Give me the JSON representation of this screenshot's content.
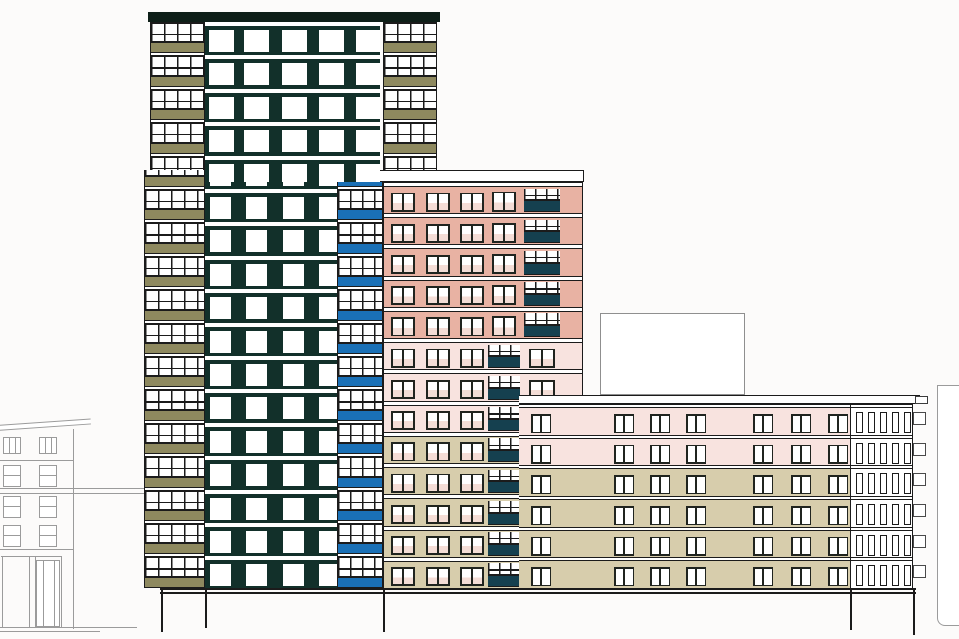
{
  "scene": {
    "width": 959,
    "height": 639,
    "background": "#fcfbfa"
  },
  "colors": {
    "line": "#1b1b1b",
    "frame": "#20241f",
    "gray": "#9b9b9b",
    "grayBox": "#8f8f8f",
    "towerBody": "#12302a",
    "roof": "#0e1f18",
    "olive": "#8e895f",
    "blue": "#1a70b6",
    "teal": "#15404f",
    "salmon": "#e8b2a3",
    "lightPink": "#f8e3df",
    "beige": "#d7cdac",
    "glass": "#ffffff",
    "paneTint": "#f4ddd6"
  },
  "tower": {
    "gridStart": 22,
    "floorH": 33.4,
    "spandrelH": 10,
    "roof": {
      "x": 148,
      "y": 12,
      "w": 292,
      "h": 10
    },
    "stacks": [
      {
        "id": "left-balcony-upper",
        "x": 150,
        "y": 22,
        "w": 55,
        "h": 148,
        "spandrel": "olive",
        "mullion": 13
      },
      {
        "id": "left-balcony-lower",
        "x": 144,
        "y": 170,
        "w": 61,
        "h": 418,
        "spandrel": "olive",
        "mullion": 13
      },
      {
        "id": "right-balcony-upper",
        "x": 383,
        "y": 22,
        "w": 54,
        "h": 148,
        "spandrel": "olive",
        "mullion": 13
      },
      {
        "id": "right-balcony-lower",
        "x": 337,
        "y": 182,
        "w": 46,
        "h": 406,
        "spandrel": "blue",
        "mullion": 12
      }
    ],
    "bodies": [
      {
        "id": "body-upper",
        "x": 205,
        "y": 22,
        "w": 175,
        "h": 160,
        "wins": [
          4,
          39,
          77,
          114,
          151
        ],
        "winW": 25,
        "winH": 22,
        "winTop": 8,
        "slabH": 4
      },
      {
        "id": "body-lower",
        "x": 205,
        "y": 182,
        "w": 132,
        "h": 406,
        "wins": [
          5,
          41,
          78,
          114
        ],
        "winW": 21,
        "winH": 22,
        "winTop": 8,
        "slabH": 4
      }
    ]
  },
  "midrise": {
    "x": 383,
    "y": 182,
    "w": 200,
    "h": 406,
    "floors": 13,
    "floorH": 31.23,
    "zones": [
      {
        "count": 5,
        "color": "salmon"
      },
      {
        "count": 3,
        "color": "lightPink"
      },
      {
        "count": 5,
        "color": "beige"
      }
    ],
    "roofSlab": {
      "x": 376,
      "y": 170,
      "w": 208,
      "h": 12
    },
    "cols": [
      {
        "x": 7,
        "w": 24,
        "kind": "win"
      },
      {
        "x": 42,
        "w": 24,
        "kind": "win"
      },
      {
        "x": 76,
        "w": 24,
        "kind": "win"
      },
      {
        "x": 104,
        "w": 32,
        "kind": "winBal"
      },
      {
        "x": 140,
        "w": 36,
        "kind": "balWin"
      }
    ],
    "balconySpandrelH": 11,
    "balconyMullion": 11
  },
  "wing": {
    "x": 519,
    "y": 404,
    "w": 394,
    "h": 184,
    "floors": 6,
    "floorH": 30.67,
    "zones": [
      {
        "count": 2,
        "color": "lightPink"
      },
      {
        "count": 4,
        "color": "beige"
      }
    ],
    "roofSlab": {
      "x": 519,
      "y": 395,
      "w": 401,
      "h": 9
    },
    "roofEnd": {
      "x": 915,
      "y": 396,
      "w": 13,
      "h": 8
    },
    "windows": [
      12,
      95,
      131,
      167,
      234,
      272,
      309
    ],
    "winW": 20,
    "winH": 19,
    "winTop": 9,
    "core": {
      "x": 331,
      "w": 63,
      "wins": [
        5,
        17,
        29,
        41,
        53
      ],
      "winW": 7,
      "winH": 21
    },
    "sideBoxes": {
      "x": 913,
      "w": 13,
      "h": 13,
      "top": 8
    }
  },
  "rooftopBox": {
    "x": 600,
    "y": 313,
    "w": 145,
    "h": 82
  },
  "baseLines": [
    {
      "x": 160,
      "y": 588,
      "w": 756,
      "h": 2
    },
    {
      "x": 160,
      "y": 592,
      "w": 756,
      "h": 1.5
    }
  ],
  "columns": [
    {
      "x": 161,
      "y": 590,
      "h": 42
    },
    {
      "x": 205,
      "y": 590,
      "h": 38
    },
    {
      "x": 383,
      "y": 590,
      "h": 42
    },
    {
      "x": 850,
      "y": 590,
      "h": 40
    },
    {
      "x": 913,
      "y": 590,
      "h": 45
    }
  ],
  "contextLeft": {
    "x": 0,
    "y": 412,
    "w": 150,
    "h": 228,
    "bodyRight": 73,
    "fascia": {
      "x": -3,
      "y": 13,
      "w": 94,
      "h": 6,
      "angle": -4
    },
    "wall": {
      "x": 73,
      "y": 17,
      "h": 200
    },
    "attic": {
      "y": 25,
      "h": 17,
      "wins": [
        3,
        39
      ],
      "winW": 18
    },
    "rows": [
      {
        "y": 53,
        "h": 22
      },
      {
        "y": 84,
        "h": 22
      },
      {
        "y": 113,
        "h": 22
      }
    ],
    "rowWins": [
      3,
      39
    ],
    "rowWinW": 18,
    "hlines": [
      {
        "y": 48,
        "x": 0,
        "w": 73
      },
      {
        "y": 76,
        "x": 0,
        "w": 146
      },
      {
        "y": 81,
        "x": 0,
        "w": 146
      },
      {
        "y": 137,
        "x": 0,
        "w": 73
      },
      {
        "y": 144,
        "x": 1,
        "w": 61
      }
    ],
    "storefront": {
      "y": 144,
      "h": 71,
      "vlines": [
        2,
        29,
        35,
        61
      ],
      "door": {
        "x": 36,
        "w": 24,
        "y": 148,
        "h": 67
      }
    },
    "ground": [
      {
        "y": 215,
        "x": 0,
        "w": 137
      },
      {
        "y": 219,
        "x": 0,
        "w": 100
      }
    ]
  },
  "contextRight": {
    "x": 937,
    "y": 385,
    "w": 30,
    "h": 241
  }
}
